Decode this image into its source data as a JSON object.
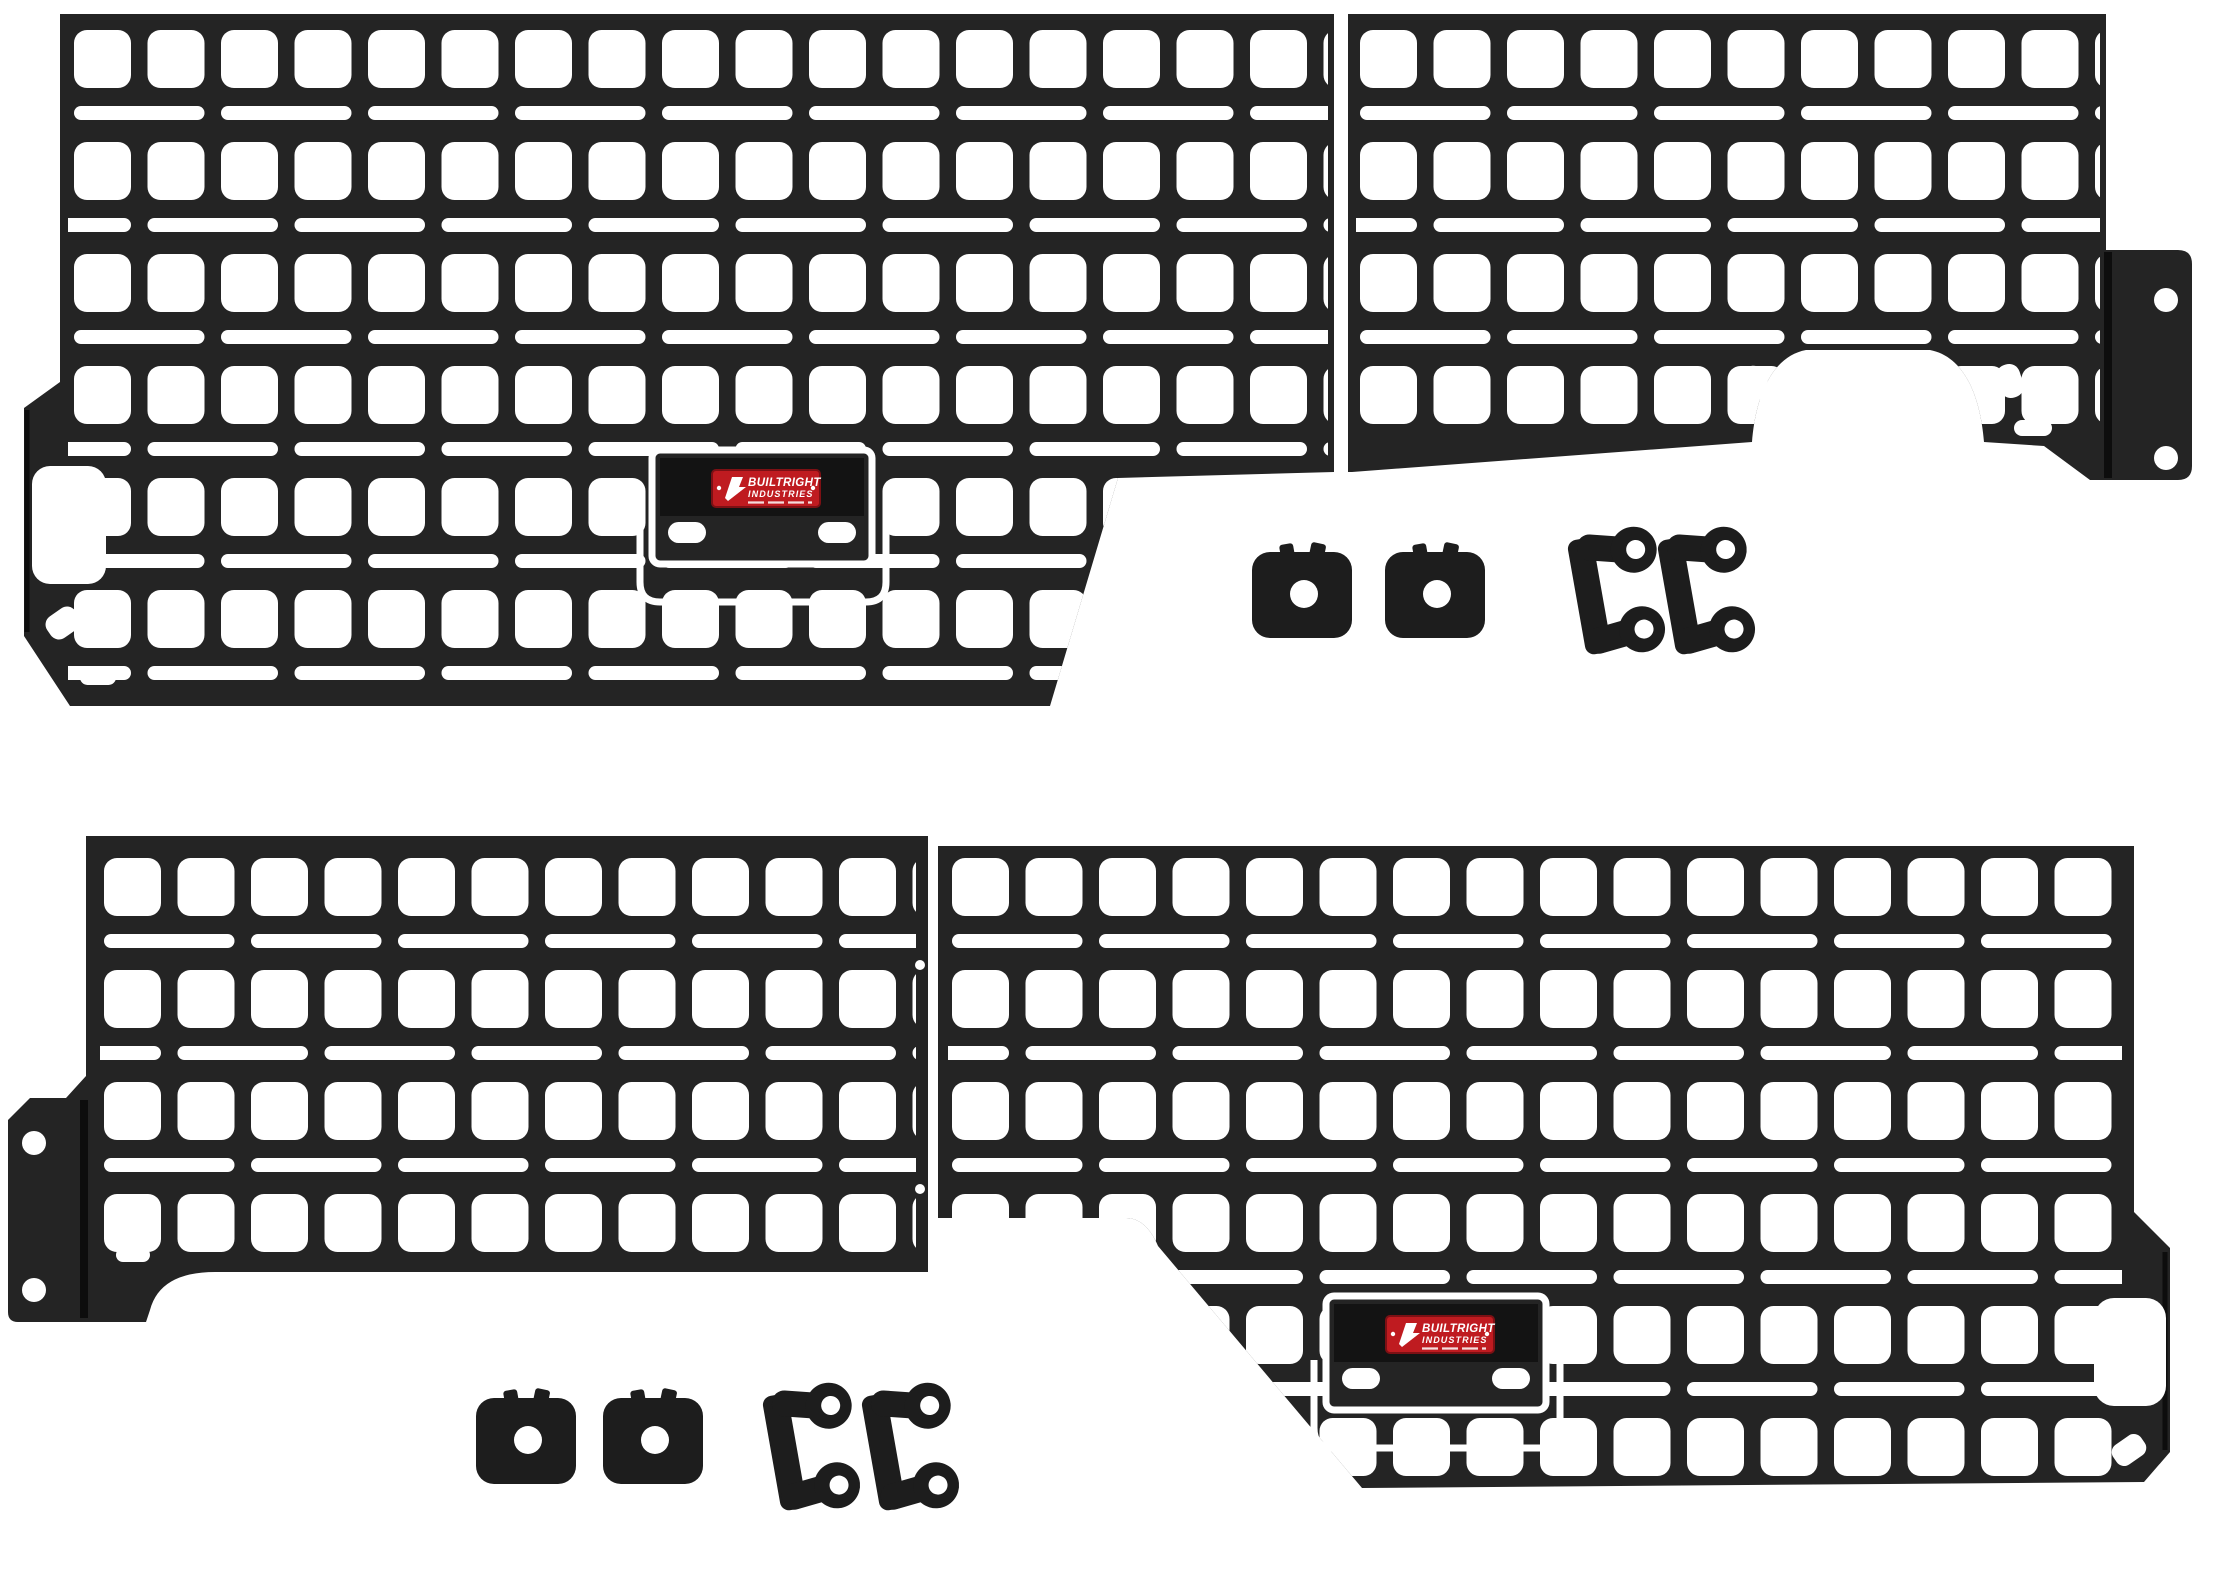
{
  "colors": {
    "background": "#ffffff",
    "panel": "#242424",
    "panel_crease": "#0d0d0d",
    "badge_red": "#bf1b20",
    "badge_red_border": "#7d1014",
    "badge_band": "#131313",
    "hardware": "#1d1d1d",
    "cutout": "#ffffff"
  },
  "badge": {
    "line1": "BUILTRIGHT",
    "line2": "INDUSTRIES"
  },
  "top_assembly": {
    "panel_count": 2,
    "grommet_count": 2,
    "bracket_count": 2,
    "flange_screw_hole_count": 2
  },
  "bottom_assembly": {
    "panel_count": 2,
    "grommet_count": 2,
    "bracket_count": 2,
    "flange_screw_hole_count": 2
  }
}
